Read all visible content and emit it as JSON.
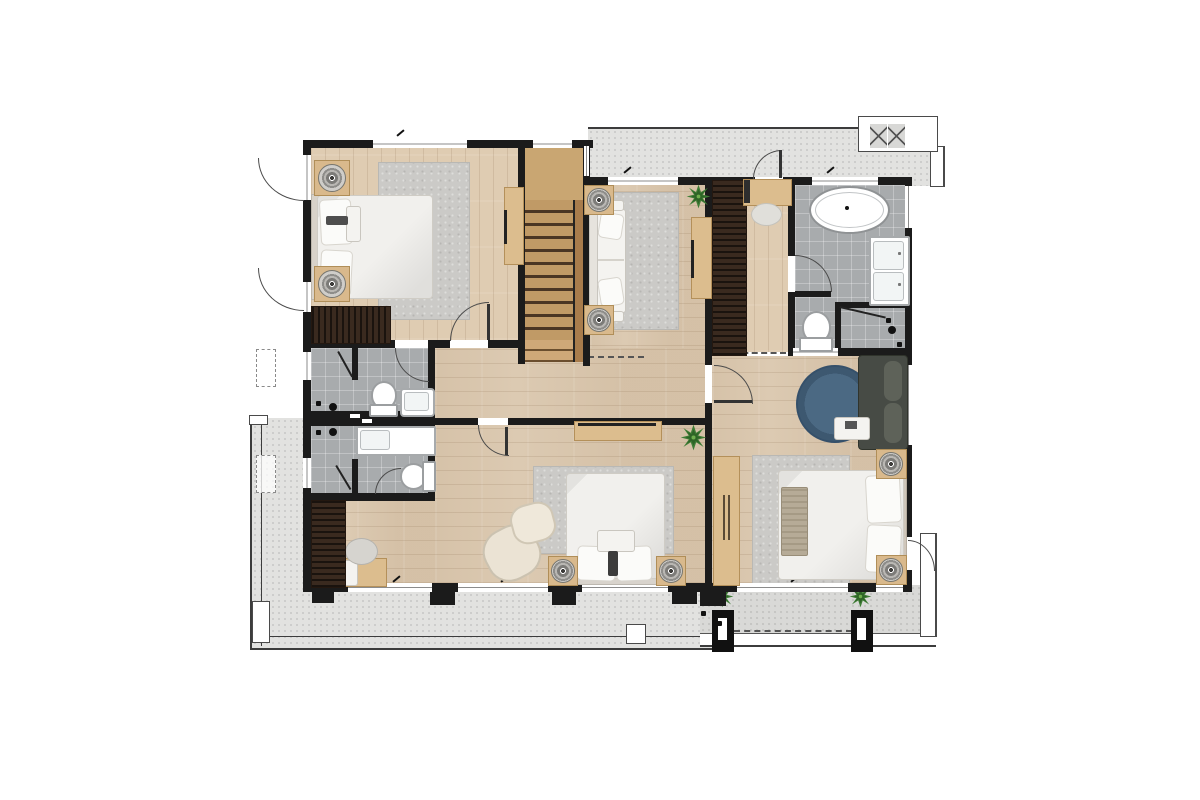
{
  "title": "second-floor-residential-floor-plan",
  "palette": {
    "background": "#ffffff",
    "wall": "#1b1b1b",
    "wood_floor": "#dccab2",
    "stair_wood": "#c09a66",
    "dark_wardrobe": "#3a2a1f",
    "light_wood_furniture": "#dcbd8e",
    "tile_floor": "#a8abad",
    "terrace_floor": "#e2e2e0",
    "balcony_floor": "#d9d9d7",
    "rug_gray": "#cbcac7",
    "rug_blue": "#44607c",
    "upholstery_white": "#f3f2ef",
    "sofa_dark": "#474b45",
    "plant_green": "#3f7d36"
  },
  "rooms": [
    {
      "name": "bedroom-upper-left",
      "floor": "wood",
      "furniture": [
        "double-bed",
        "two-round-lamp-side-tables",
        "area-rug",
        "slatted-dresser",
        "tv-console",
        "two-casement-windows"
      ]
    },
    {
      "name": "staircase",
      "floor": "wood-treads",
      "details": [
        "upper-landing",
        "thirteen-treads",
        "handrail",
        "flared-bottom-steps"
      ]
    },
    {
      "name": "family-sitting-area",
      "floor": "wood",
      "furniture": [
        "sofa",
        "two-lamp-side-tables",
        "area-rug",
        "tv-console",
        "potted-plant"
      ]
    },
    {
      "name": "walk-in-closet",
      "floor": "wood",
      "furniture": [
        "slatted-wardrobe",
        "vanity-desk",
        "stool",
        "balcony-door"
      ]
    },
    {
      "name": "master-bathroom",
      "floor": "tile",
      "fixtures": [
        "freestanding-oval-bathtub",
        "double-sink-vanity",
        "toilet",
        "walk-in-shower"
      ]
    },
    {
      "name": "ensuite-bathroom-upper",
      "floor": "tile",
      "fixtures": [
        "shower-stall",
        "toilet",
        "sink"
      ]
    },
    {
      "name": "ensuite-bathroom-lower",
      "floor": "tile",
      "fixtures": [
        "shower-stall",
        "toilet",
        "sink-counter"
      ]
    },
    {
      "name": "bedroom-lower-middle",
      "floor": "wood",
      "furniture": [
        "double-bed",
        "two-side-tables-with-lamps",
        "area-rug",
        "lounge-chair",
        "ottoman",
        "tv-console",
        "desk",
        "desk-chair",
        "wardrobe",
        "potted-plant"
      ]
    },
    {
      "name": "master-bedroom",
      "floor": "wood",
      "furniture": [
        "king-bed",
        "two-side-tables-with-lamps",
        "striped-bed-runner",
        "area-rug",
        "round-blue-rug",
        "dark-sofa",
        "coffee-table",
        "wardrobe"
      ]
    },
    {
      "name": "upper-balcony",
      "floor": "concrete",
      "details": [
        "door-from-closet",
        "louvered-platform-with-cross-hatch"
      ]
    },
    {
      "name": "lower-terrace",
      "floor": "concrete",
      "details": [
        "perimeter-railing",
        "column-outlines"
      ]
    },
    {
      "name": "lower-balcony",
      "floor": "concrete",
      "details": [
        "two-black-columns",
        "two-potted-plants",
        "floor-drains",
        "door-from-master-bedroom"
      ]
    }
  ]
}
